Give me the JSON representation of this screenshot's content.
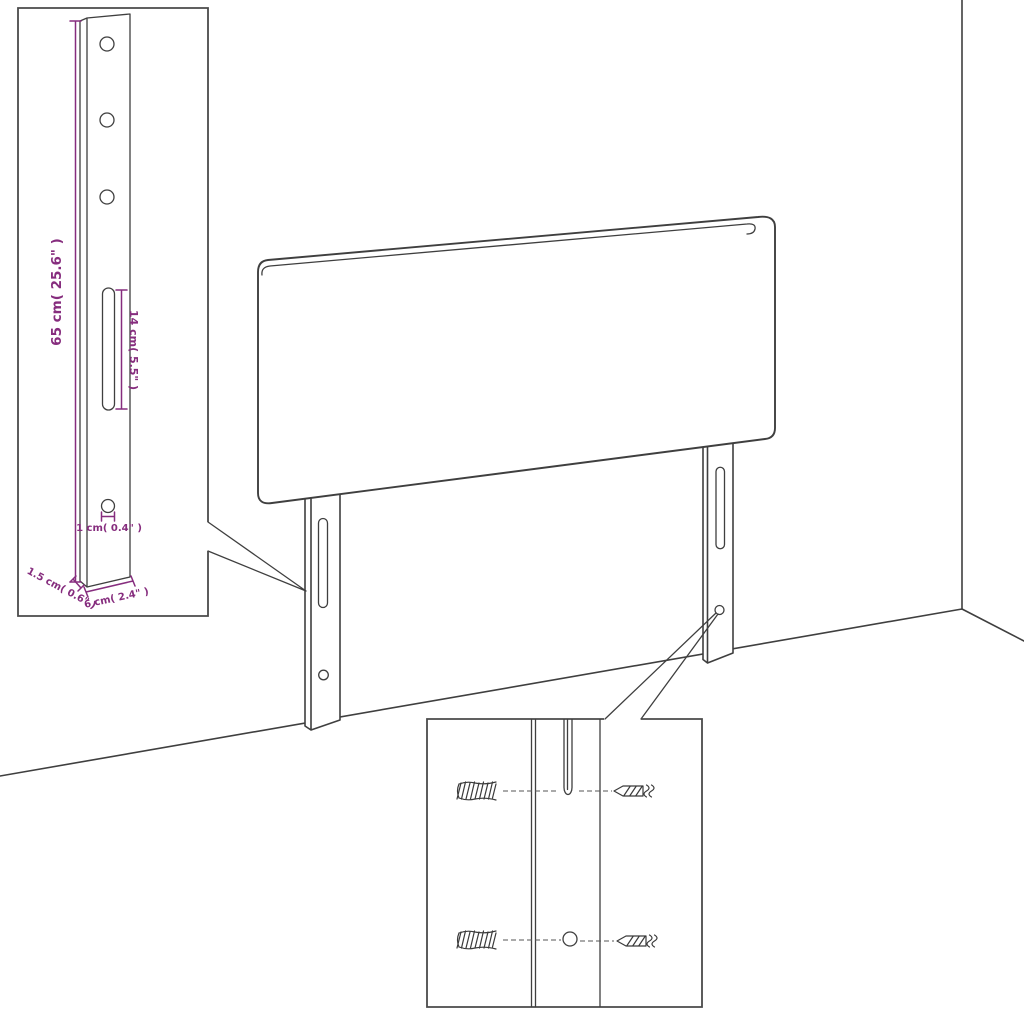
{
  "palette": {
    "background": "#ffffff",
    "line": "#3f3f3f",
    "inset_border": "#4a4a4a",
    "dimension": "#862d7e"
  },
  "labels": {
    "height": "65 cm( 25.6\" )",
    "slot": "14 cm( 5.5\" )",
    "hole": "1 cm( 0.4\" )",
    "thickness": "1.5 cm( 0.6\" )",
    "width": "6 cm( 2.4\" )"
  },
  "icons": {
    "wall_plug": "hatched-wall-plug",
    "screw": "left-pointing-screw"
  }
}
